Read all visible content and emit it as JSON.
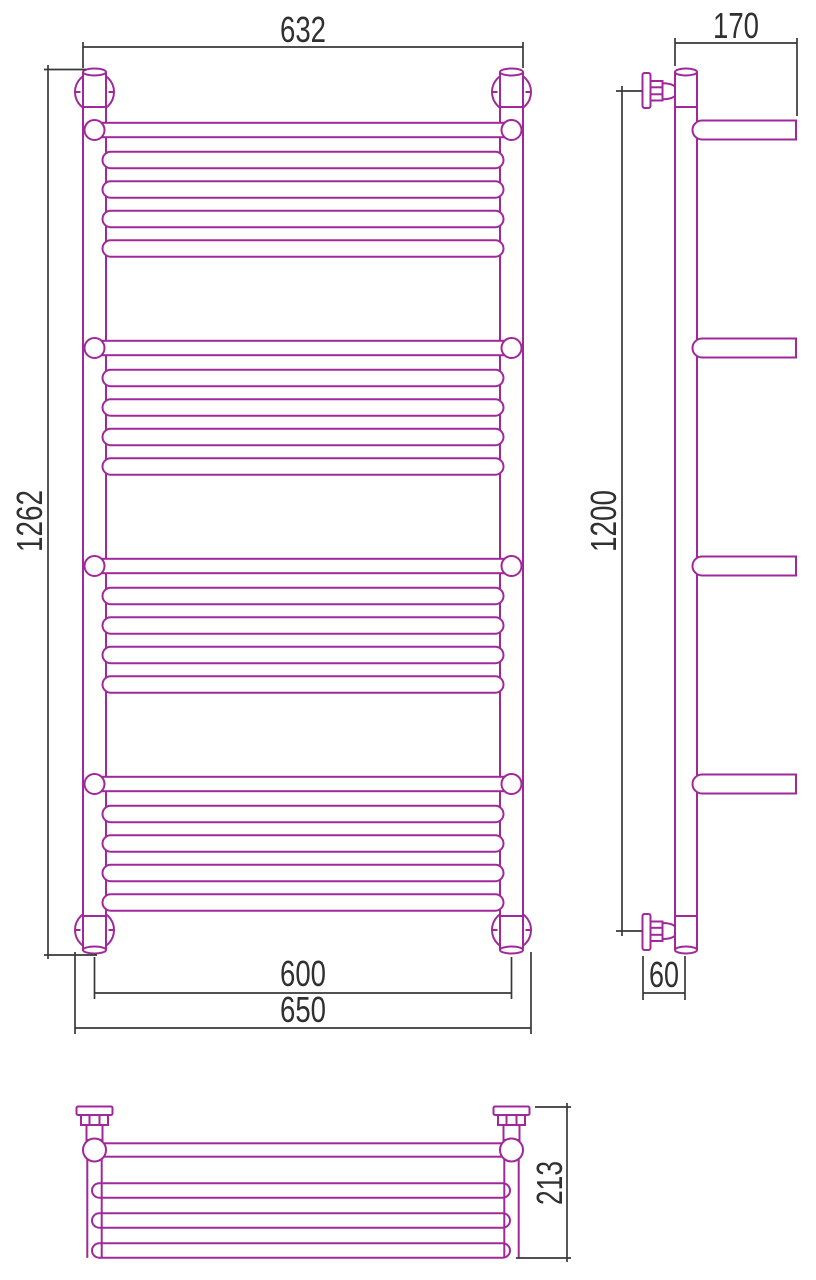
{
  "document": {
    "type": "technical-drawing",
    "subject": "ladder towel rail with shelves, three orthographic views",
    "background": "#ffffff"
  },
  "colors": {
    "outline": "#A0289A",
    "dimension_lines": "#383838",
    "text": "#303030"
  },
  "views": {
    "front": {
      "dim_width_top": "632",
      "dim_height": "1262",
      "dim_width_centers": "600",
      "dim_width_overall": "650",
      "shelf_count": 4,
      "rungs_per_group": 4
    },
    "side": {
      "dim_depth_top": "170",
      "dim_height": "1200",
      "dim_valve": "60",
      "arm_count": 4
    },
    "plan": {
      "dim_depth": "213",
      "cross_bar_count": 3
    }
  }
}
